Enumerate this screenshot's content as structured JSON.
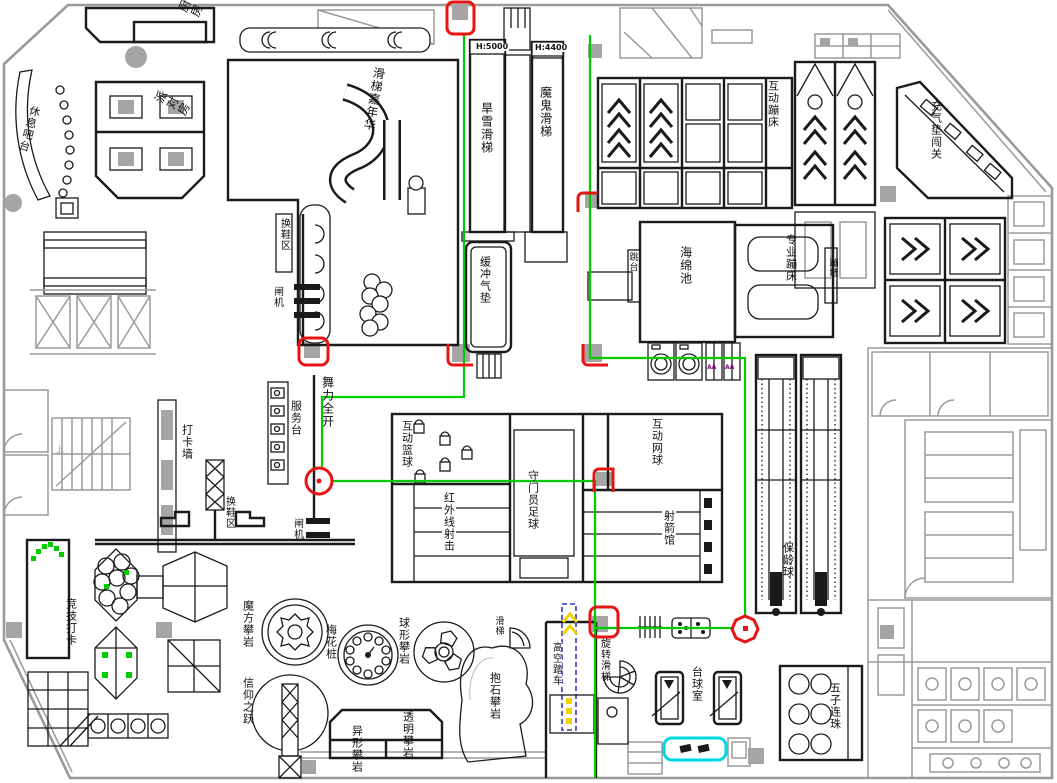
{
  "title": "室内乐园平面图",
  "colors": {
    "gray": "#9a9a9a",
    "grayfill": "#a5a5a5",
    "green": "#00cc00",
    "red": "#e81313",
    "slide_red": "#f40000",
    "blue": "#3333cc",
    "yellow": "#f0d400",
    "cyan": "#00d8e0",
    "purple": "#8a0a8a"
  },
  "labels": [
    {
      "id": "kitchen",
      "text": "厨房",
      "x": 176,
      "y": 10,
      "v": true,
      "size": 12,
      "rot": -68
    },
    {
      "id": "rest-bar",
      "text": "休息吧台",
      "x": 30,
      "y": 104,
      "v": true,
      "size": 11,
      "rot": 16
    },
    {
      "id": "party-room",
      "text": "派对房",
      "x": 152,
      "y": 100,
      "v": true,
      "size": 12,
      "rot": -62
    },
    {
      "id": "slide-carnival",
      "text": "滑梯嘉年华",
      "x": 373,
      "y": 66,
      "v": true,
      "size": 12,
      "rot": 10
    },
    {
      "id": "h5000",
      "text": "H:5000",
      "x": 475,
      "y": 43,
      "v": false,
      "size": 8,
      "bold": true,
      "bg": true
    },
    {
      "id": "h4400",
      "text": "H:4400",
      "x": 534,
      "y": 44,
      "v": false,
      "size": 8,
      "bold": true,
      "bg": true
    },
    {
      "id": "dry-snow-slide",
      "text": "旱雪滑梯",
      "x": 480,
      "y": 102,
      "v": true,
      "size": 12
    },
    {
      "id": "devil-slide",
      "text": "魔鬼滑梯",
      "x": 539,
      "y": 86,
      "v": true,
      "size": 12
    },
    {
      "id": "buffer-cushion",
      "text": "缓冲气垫",
      "x": 479,
      "y": 256,
      "v": true,
      "size": 11
    },
    {
      "id": "interactive-trampoline",
      "text": "互动蹦床",
      "x": 767,
      "y": 80,
      "v": true,
      "size": 11
    },
    {
      "id": "inflatable-challenge",
      "text": "充气垫闯关",
      "x": 930,
      "y": 100,
      "v": true,
      "size": 11
    },
    {
      "id": "sponge-pool",
      "text": "海绵池",
      "x": 679,
      "y": 246,
      "v": true,
      "size": 12
    },
    {
      "id": "pro-trampoline",
      "text": "专业蹦床",
      "x": 785,
      "y": 234,
      "v": true,
      "size": 11
    },
    {
      "id": "diving-platform",
      "text": "跳台",
      "x": 627,
      "y": 252,
      "v": true,
      "size": 9
    },
    {
      "id": "bounce-wall",
      "text": "蹦墙",
      "x": 827,
      "y": 258,
      "v": true,
      "size": 9
    },
    {
      "id": "shoe-area-1",
      "text": "换鞋区",
      "x": 278,
      "y": 218,
      "v": true,
      "size": 10
    },
    {
      "id": "gate-1",
      "text": "闸机",
      "x": 271,
      "y": 286,
      "v": true,
      "size": 10
    },
    {
      "id": "dance-zone",
      "text": "舞力全开",
      "x": 321,
      "y": 376,
      "v": true,
      "size": 12
    },
    {
      "id": "service-desk",
      "text": "服务台",
      "x": 290,
      "y": 400,
      "v": true,
      "size": 11
    },
    {
      "id": "checkin-wall",
      "text": "打卡墙",
      "x": 181,
      "y": 424,
      "v": true,
      "size": 11
    },
    {
      "id": "shoe-area-2",
      "text": "换鞋区",
      "x": 223,
      "y": 496,
      "v": true,
      "size": 10
    },
    {
      "id": "gate-2",
      "text": "闸机",
      "x": 291,
      "y": 518,
      "v": true,
      "size": 10
    },
    {
      "id": "interactive-basketball",
      "text": "互动篮球",
      "x": 401,
      "y": 420,
      "v": true,
      "size": 11
    },
    {
      "id": "goalkeeper-football",
      "text": "守门员足球",
      "x": 527,
      "y": 470,
      "v": true,
      "size": 11
    },
    {
      "id": "infrared-shooting",
      "text": "红外线射击",
      "x": 442,
      "y": 492,
      "v": true,
      "size": 11,
      "bg": true
    },
    {
      "id": "archery-hall",
      "text": "射箭馆",
      "x": 662,
      "y": 510,
      "v": true,
      "size": 11,
      "bg": true
    },
    {
      "id": "interactive-tennis",
      "text": "互动网球",
      "x": 651,
      "y": 418,
      "v": true,
      "size": 11
    },
    {
      "id": "bowling",
      "text": "保龄球",
      "x": 782,
      "y": 542,
      "v": true,
      "size": 11
    },
    {
      "id": "competitive-checkin",
      "text": "竞技打卡",
      "x": 65,
      "y": 598,
      "v": true,
      "size": 11
    },
    {
      "id": "cube-climbing",
      "text": "魔方攀岩",
      "x": 242,
      "y": 600,
      "v": true,
      "size": 11
    },
    {
      "id": "plum-piles",
      "text": "梅花桩",
      "x": 325,
      "y": 624,
      "v": true,
      "size": 11
    },
    {
      "id": "sphere-climbing",
      "text": "球形攀岩",
      "x": 398,
      "y": 617,
      "v": true,
      "size": 11
    },
    {
      "id": "leap-of-faith",
      "text": "信仰之跃",
      "x": 242,
      "y": 677,
      "v": true,
      "size": 11
    },
    {
      "id": "shaped-climbing",
      "text": "异形攀岩",
      "x": 351,
      "y": 725,
      "v": true,
      "size": 11
    },
    {
      "id": "transparent-climbing",
      "text": "透明攀岩",
      "x": 402,
      "y": 711,
      "v": true,
      "size": 11
    },
    {
      "id": "boulder-climbing",
      "text": "抱石攀岩",
      "x": 489,
      "y": 672,
      "v": true,
      "size": 11
    },
    {
      "id": "small-slide",
      "text": "滑梯",
      "x": 493,
      "y": 616,
      "v": true,
      "size": 9
    },
    {
      "id": "sky-bike",
      "text": "高空踏车",
      "x": 549,
      "y": 642,
      "v": true,
      "size": 10,
      "bg": true
    },
    {
      "id": "spiral-slide",
      "text": "旋转滑梯",
      "x": 598,
      "y": 638,
      "v": true,
      "size": 10
    },
    {
      "id": "billiards-room",
      "text": "台球室",
      "x": 691,
      "y": 666,
      "v": true,
      "size": 11
    },
    {
      "id": "gomoku",
      "text": "五子连珠",
      "x": 829,
      "y": 682,
      "v": true,
      "size": 11
    },
    {
      "id": "outlet-mark-1",
      "text": "AA",
      "x": 707,
      "y": 365,
      "v": false,
      "size": 6,
      "color": "#8a0a8a",
      "bold": true
    },
    {
      "id": "outlet-mark-2",
      "text": "AA",
      "x": 725,
      "y": 365,
      "v": false,
      "size": 6,
      "color": "#8a0a8a",
      "bold": true
    },
    {
      "id": "stairs-up",
      "text": "上",
      "x": 56,
      "y": 446,
      "v": false,
      "size": 8,
      "color": "#9a9a9a"
    }
  ]
}
